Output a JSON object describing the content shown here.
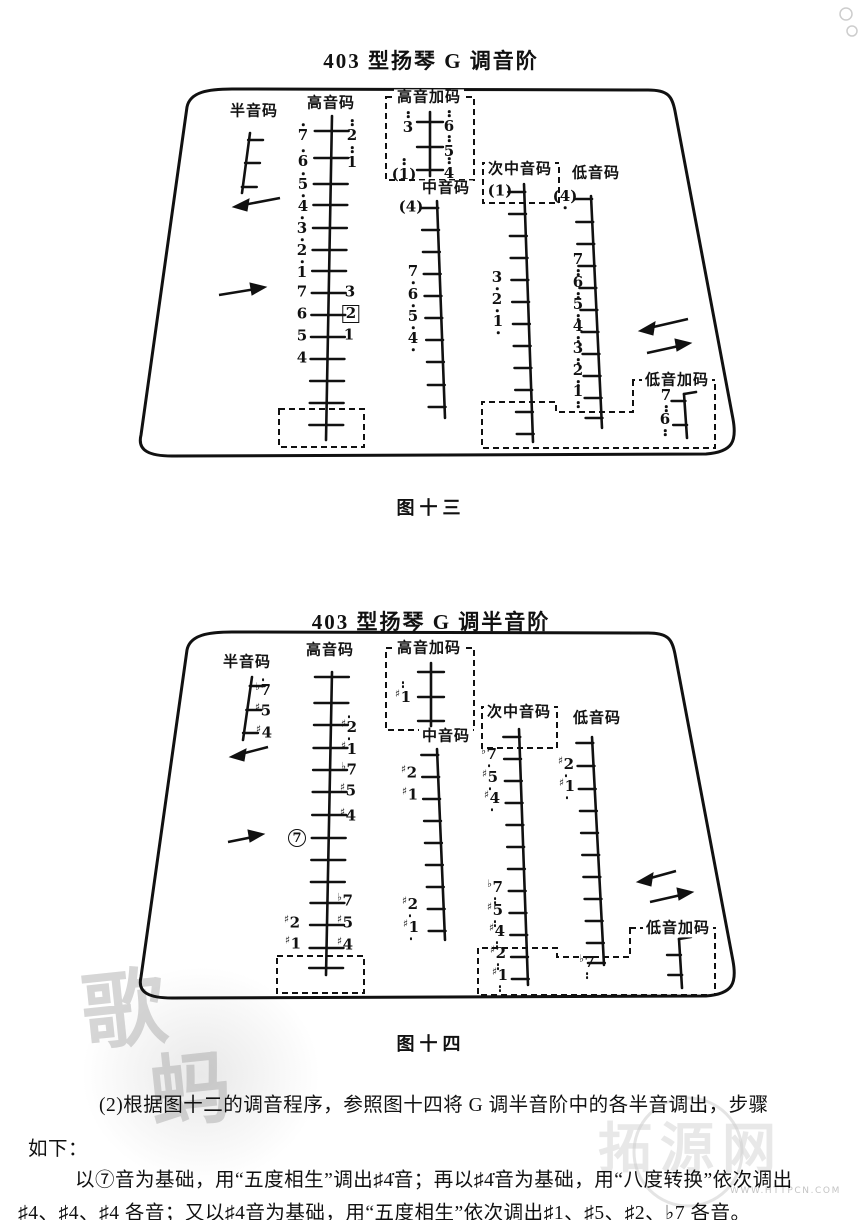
{
  "figures": [
    {
      "title": "403 型扬琴 G 调音阶",
      "caption": "图十三",
      "labels": [
        {
          "t": "半音码",
          "x": 254,
          "y": 112
        },
        {
          "t": "高音码",
          "x": 331,
          "y": 104
        },
        {
          "t": "高音加码",
          "x": 429,
          "y": 98
        },
        {
          "t": "中音码",
          "x": 446,
          "y": 189
        },
        {
          "t": "次中音码",
          "x": 520,
          "y": 170
        },
        {
          "t": "低音码",
          "x": 596,
          "y": 174
        },
        {
          "t": "低音加码",
          "x": 677,
          "y": 381
        }
      ],
      "notes": [
        {
          "x": 303,
          "y": 133,
          "n": "7",
          "d": 1
        },
        {
          "x": 303,
          "y": 159,
          "n": "6",
          "d": 1
        },
        {
          "x": 303,
          "y": 182,
          "n": "5",
          "d": 1
        },
        {
          "x": 303,
          "y": 204,
          "n": "4",
          "d": 1
        },
        {
          "x": 302,
          "y": 226,
          "n": "3",
          "d": 1
        },
        {
          "x": 302,
          "y": 248,
          "n": "2",
          "d": 1
        },
        {
          "x": 302,
          "y": 270,
          "n": "1",
          "d": 1
        },
        {
          "x": 302,
          "y": 292,
          "n": "7",
          "d": 0
        },
        {
          "x": 302,
          "y": 314,
          "n": "6",
          "d": 0
        },
        {
          "x": 302,
          "y": 336,
          "n": "5",
          "d": 0
        },
        {
          "x": 302,
          "y": 358,
          "n": "4",
          "d": 0
        },
        {
          "x": 352,
          "y": 131,
          "n": "2",
          "d": 2
        },
        {
          "x": 352,
          "y": 158,
          "n": "1",
          "d": 2
        },
        {
          "x": 350,
          "y": 292,
          "n": "3",
          "d": 0
        },
        {
          "x": 351,
          "y": 314,
          "n": "2",
          "d": 0,
          "w": "box"
        },
        {
          "x": 349,
          "y": 335,
          "n": "1",
          "d": 0
        },
        {
          "x": 408,
          "y": 123,
          "n": "3",
          "d": 2
        },
        {
          "x": 449,
          "y": 122,
          "n": "6",
          "d": 2
        },
        {
          "x": 449,
          "y": 147,
          "n": "5",
          "d": 2
        },
        {
          "x": 449,
          "y": 169,
          "n": "4",
          "d": 2
        },
        {
          "x": 404,
          "y": 170,
          "n": "1",
          "d": 2,
          "w": "paren"
        },
        {
          "x": 411,
          "y": 207,
          "n": "4",
          "d": 0,
          "w": "paren"
        },
        {
          "x": 413,
          "y": 274,
          "n": "7",
          "d": -1
        },
        {
          "x": 413,
          "y": 297,
          "n": "6",
          "d": -1
        },
        {
          "x": 413,
          "y": 319,
          "n": "5",
          "d": -1
        },
        {
          "x": 413,
          "y": 341,
          "n": "4",
          "d": -1
        },
        {
          "x": 500,
          "y": 191,
          "n": "1",
          "d": 0,
          "w": "paren"
        },
        {
          "x": 497,
          "y": 280,
          "n": "3",
          "d": -1
        },
        {
          "x": 497,
          "y": 302,
          "n": "2",
          "d": -1
        },
        {
          "x": 498,
          "y": 324,
          "n": "1",
          "d": -1
        },
        {
          "x": 565,
          "y": 199,
          "n": "4",
          "d": -1,
          "w": "paren"
        },
        {
          "x": 578,
          "y": 264,
          "n": "7",
          "d": -2
        },
        {
          "x": 578,
          "y": 287,
          "n": "6",
          "d": -2
        },
        {
          "x": 578,
          "y": 309,
          "n": "5",
          "d": -2
        },
        {
          "x": 578,
          "y": 331,
          "n": "4",
          "d": -2
        },
        {
          "x": 578,
          "y": 353,
          "n": "3",
          "d": -2
        },
        {
          "x": 578,
          "y": 375,
          "n": "2",
          "d": -2
        },
        {
          "x": 578,
          "y": 396,
          "n": "1",
          "d": -2
        },
        {
          "x": 666,
          "y": 400,
          "n": "7",
          "d": -2
        },
        {
          "x": 665,
          "y": 424,
          "n": "6",
          "d": -2
        }
      ]
    },
    {
      "title": "403 型扬琴 G 调半音阶",
      "caption": "图十四",
      "labels": [
        {
          "t": "半音码",
          "x": 247,
          "y": 663
        },
        {
          "t": "高音码",
          "x": 330,
          "y": 651
        },
        {
          "t": "高音加码",
          "x": 429,
          "y": 649
        },
        {
          "t": "中音码",
          "x": 446,
          "y": 737
        },
        {
          "t": "次中音码",
          "x": 519,
          "y": 713
        },
        {
          "t": "低音码",
          "x": 597,
          "y": 719
        },
        {
          "t": "低音加码",
          "x": 678,
          "y": 929
        }
      ],
      "notes": [
        {
          "x": 263,
          "y": 688,
          "n": "7",
          "a": "b",
          "d": 1
        },
        {
          "x": 263,
          "y": 711,
          "n": "5",
          "a": "#",
          "d": 0
        },
        {
          "x": 264,
          "y": 733,
          "n": "4",
          "a": "#",
          "d": 0
        },
        {
          "x": 349,
          "y": 725,
          "n": "2",
          "a": "#",
          "d": 1
        },
        {
          "x": 349,
          "y": 747,
          "n": "1",
          "a": "#",
          "d": 1
        },
        {
          "x": 349,
          "y": 770,
          "n": "7",
          "a": "b",
          "d": 0
        },
        {
          "x": 348,
          "y": 791,
          "n": "5",
          "a": "#",
          "d": 0
        },
        {
          "x": 348,
          "y": 816,
          "n": "4",
          "a": "#",
          "d": 0
        },
        {
          "x": 345,
          "y": 901,
          "n": "7",
          "a": "b",
          "d": 0
        },
        {
          "x": 345,
          "y": 923,
          "n": "5",
          "a": "#",
          "d": 0
        },
        {
          "x": 345,
          "y": 945,
          "n": "4",
          "a": "#",
          "d": 0
        },
        {
          "x": 297,
          "y": 838,
          "n": "7",
          "d": 0,
          "w": "circle"
        },
        {
          "x": 292,
          "y": 923,
          "n": "2",
          "a": "#",
          "d": 0
        },
        {
          "x": 293,
          "y": 944,
          "n": "1",
          "a": "#",
          "d": 0
        },
        {
          "x": 403,
          "y": 693,
          "n": "1",
          "a": "#",
          "d": 2
        },
        {
          "x": 409,
          "y": 773,
          "n": "2",
          "a": "#",
          "d": 0
        },
        {
          "x": 410,
          "y": 795,
          "n": "1",
          "a": "#",
          "d": 0
        },
        {
          "x": 410,
          "y": 907,
          "n": "2",
          "a": "#",
          "d": -1
        },
        {
          "x": 411,
          "y": 930,
          "n": "1",
          "a": "#",
          "d": -1
        },
        {
          "x": 489,
          "y": 757,
          "n": "7",
          "a": "b",
          "d": -1
        },
        {
          "x": 490,
          "y": 780,
          "n": "5",
          "a": "#",
          "d": -1
        },
        {
          "x": 492,
          "y": 801,
          "n": "4",
          "a": "#",
          "d": -1
        },
        {
          "x": 495,
          "y": 892,
          "n": "7",
          "a": "b",
          "d": -2
        },
        {
          "x": 495,
          "y": 915,
          "n": "5",
          "a": "#",
          "d": -2
        },
        {
          "x": 497,
          "y": 936,
          "n": "4",
          "a": "#",
          "d": -2
        },
        {
          "x": 498,
          "y": 958,
          "n": "2",
          "a": "#",
          "d": -2
        },
        {
          "x": 500,
          "y": 980,
          "n": "1",
          "a": "#",
          "d": -2
        },
        {
          "x": 566,
          "y": 767,
          "n": "2",
          "a": "#",
          "d": -1
        },
        {
          "x": 567,
          "y": 789,
          "n": "1",
          "a": "#",
          "d": -1
        },
        {
          "x": 587,
          "y": 967,
          "n": "7",
          "a": "b",
          "d": -2
        }
      ]
    }
  ],
  "paragraph": {
    "line1": "(2)根据图十二的调音程序，参照图十四将 G 调半音阶中的各半音调出，步骤",
    "line2": "如下：",
    "line3": "以⑦音为基础，用“五度相生”调出♯4̇音；再以♯4̇音为基础，用“八度转换”依次调出",
    "line4": "♯4、♯4̣、♯4̤ 各音；又以♯4音为基础，用“五度相生”依次调出♯1、♯5、♯2、♭7 各音。"
  },
  "watermark": {
    "url": "WWW.HTTPCN.COM",
    "logo_text": "拓源网",
    "stamp_chars": [
      "歌",
      "蚂"
    ]
  }
}
